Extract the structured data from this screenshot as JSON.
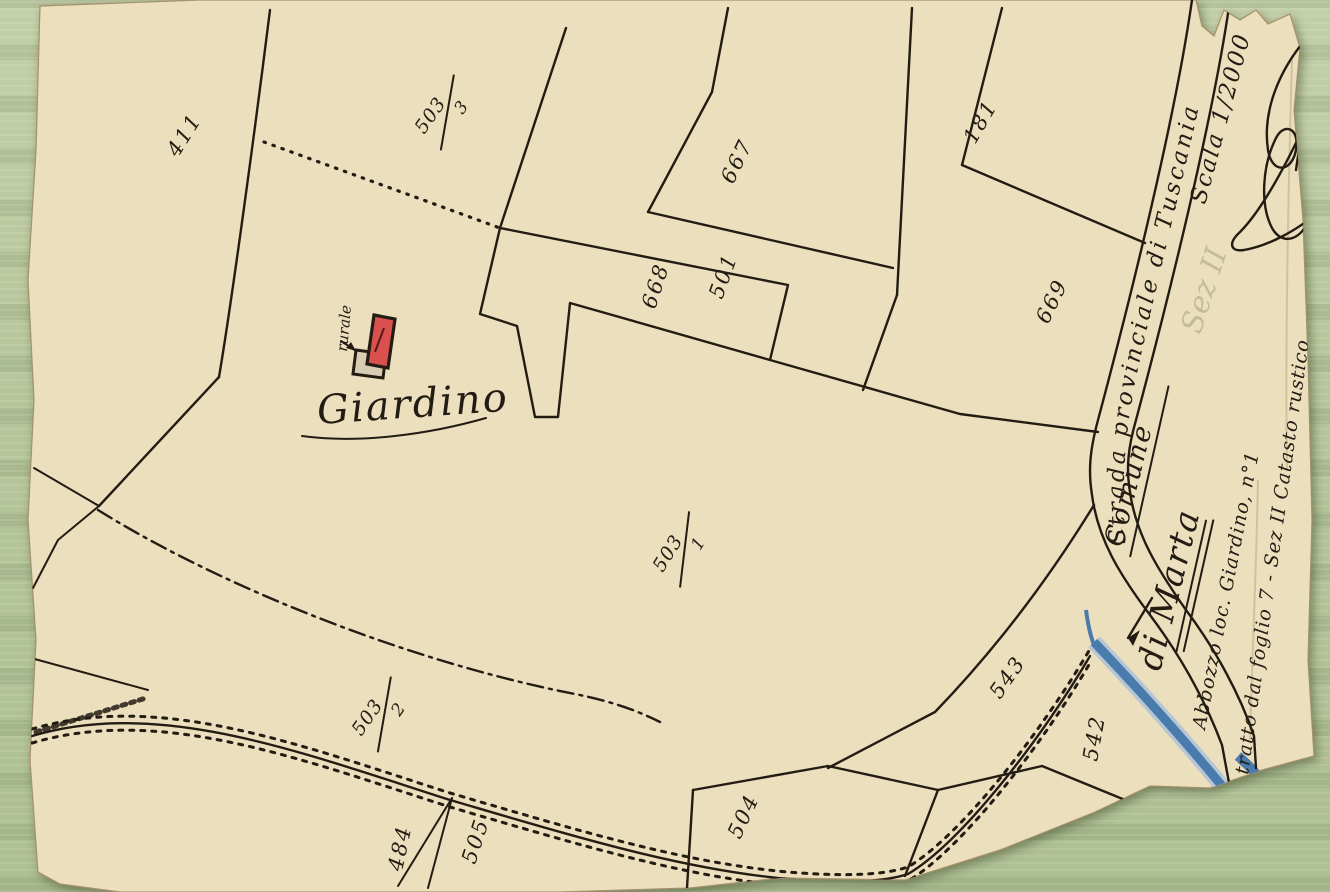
{
  "scan": {
    "background_color": "#b7c69c",
    "paper_color": "#ecdfbd",
    "ink_color": "#231c13",
    "stream_color": "#4a7bad",
    "building_fill": "#d9504e"
  },
  "map": {
    "locality_label": "Giardino",
    "building_label": "rurale",
    "road_label": "Strada provinciale di Tuscania",
    "municipality_line1": "Comune",
    "municipality_line2": "di Marta",
    "scale_label": "Scala 1/2000",
    "note_line1": "Abbozzo loc. Giardino, n°1",
    "note_line2": "tratto dal foglio 7 - Sez II Catasto rustico",
    "pencil_note": "Sez II",
    "parcels": [
      {
        "label": "411"
      },
      {
        "num": "503",
        "den": "3"
      },
      {
        "label": "667"
      },
      {
        "label": "501"
      },
      {
        "label": "668"
      },
      {
        "label": "181"
      },
      {
        "label": "669"
      },
      {
        "num": "503",
        "den": "1"
      },
      {
        "num": "503",
        "den": "2"
      },
      {
        "label": "543"
      },
      {
        "label": "542"
      },
      {
        "label": "504"
      },
      {
        "label": "505"
      },
      {
        "label": "484"
      }
    ]
  }
}
